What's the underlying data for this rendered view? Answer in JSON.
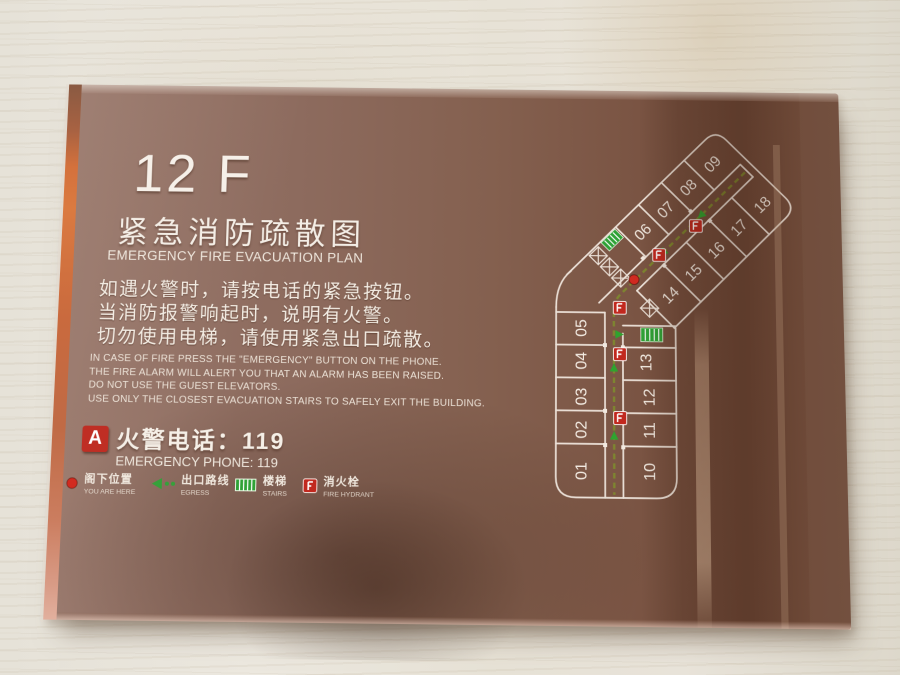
{
  "sign": {
    "floor_label": "12 F",
    "title_cn": "紧急消防疏散图",
    "title_en": "EMERGENCY FIRE EVACUATION PLAN",
    "instructions_cn": [
      "如遇火警时，请按电话的紧急按钮。",
      "当消防报警响起时，说明有火警。",
      "切勿使用电梯，请使用紧急出口疏散。"
    ],
    "instructions_en": [
      "IN CASE OF FIRE PRESS THE  \"EMERGENCY\"  BUTTON ON THE PHONE.",
      "THE FIRE ALARM WILL ALERT YOU THAT AN ALARM HAS BEEN RAISED.",
      "DO NOT USE THE GUEST ELEVATORS.",
      "USE ONLY THE CLOSEST EVACUATION STAIRS TO SAFELY EXIT THE BUILDING."
    ],
    "phone": {
      "marker": "A",
      "cn": "火警电话：119",
      "en": "EMERGENCY PHONE: 119"
    },
    "legend": [
      {
        "icon": "you-are-here-dot",
        "cn": "阁下位置",
        "en": "YOU ARE HERE"
      },
      {
        "icon": "egress-route-arrow",
        "cn": "出口路线",
        "en": "EGRESS"
      },
      {
        "icon": "stairs",
        "cn": "楼梯",
        "en": "STAIRS"
      },
      {
        "icon": "fire-hydrant",
        "cn": "消火栓",
        "en": "FIRE HYDRANT"
      }
    ],
    "floorplan": {
      "left_column": [
        "01",
        "02",
        "03",
        "04",
        "05"
      ],
      "right_column": [
        "10",
        "11",
        "12",
        "13"
      ],
      "upper_wing_rooms": [
        "06",
        "07",
        "08",
        "09"
      ],
      "lower_wing_rooms": [
        "14",
        "15",
        "16",
        "17",
        "18"
      ]
    },
    "colors": {
      "panel_brown": "#86655a",
      "edge_orange": "#d4713c",
      "alert_red": "#c1281e",
      "safety_green": "#2fa236",
      "egress_olive": "#7e8b2e",
      "plan_line": "#f2e9e0",
      "wall_beige": "#e8e4da"
    }
  }
}
